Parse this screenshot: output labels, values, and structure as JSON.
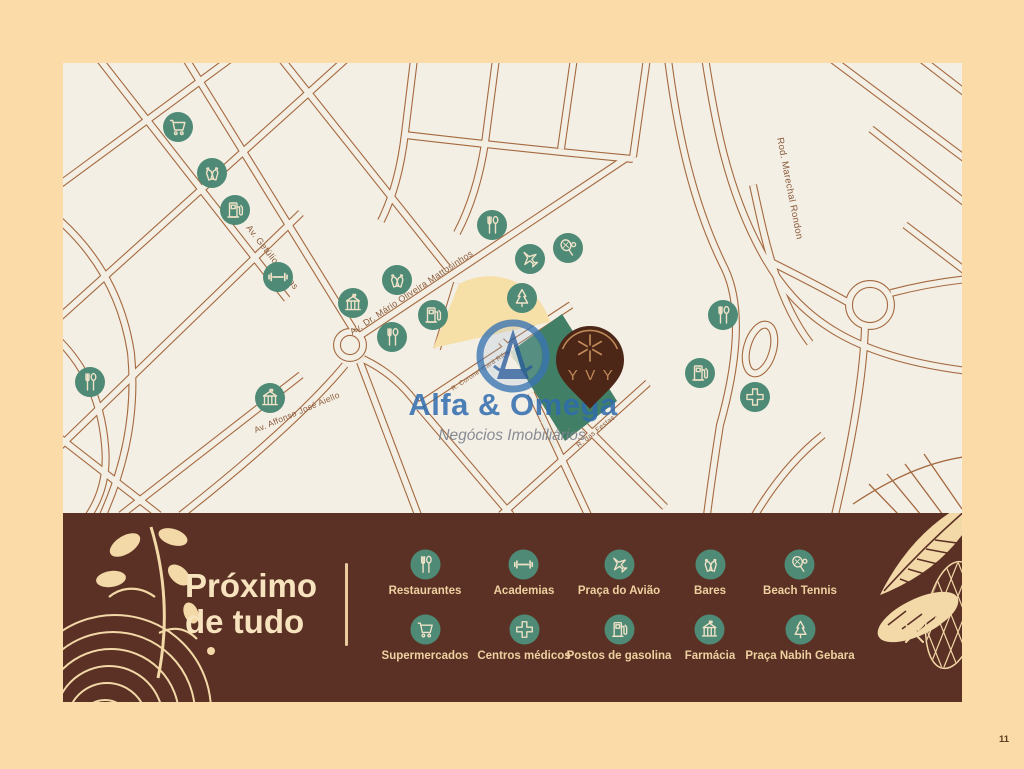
{
  "page": {
    "number": "11"
  },
  "watermark": {
    "title": "Alfa & Omega",
    "subtitle": "Negócios Imobiliários"
  },
  "pin": {
    "label": "YVY"
  },
  "map": {
    "street_labels": [
      {
        "text": "Av. Getúlio Vargas",
        "x": 207,
        "y": 196,
        "angle": 52,
        "size": 9
      },
      {
        "text": "Av. Dr. Mário Oliveira Mattosinhos",
        "x": 350,
        "y": 232,
        "angle": -33.5,
        "size": 9
      },
      {
        "text": "Av. Affonso José Aiello",
        "x": 235,
        "y": 352,
        "angle": -23,
        "size": 8.5
      },
      {
        "text": "Rod. Marechal Rondon",
        "x": 724,
        "y": 126,
        "angle": 79,
        "size": 9.5
      },
      {
        "text": "R. das Festas",
        "x": 534,
        "y": 370,
        "angle": -39,
        "size": 7
      },
      {
        "text": "R. Coronel Cará Ribas",
        "x": 420,
        "y": 308,
        "angle": -33.5,
        "size": 6.5
      },
      {
        "text": "R. Joaquim Lima",
        "x": 480,
        "y": 362,
        "angle": 65,
        "size": 6.5,
        "light": true
      }
    ],
    "pois": [
      {
        "type": "cart",
        "x": 115,
        "y": 64
      },
      {
        "type": "bar",
        "x": 149,
        "y": 110
      },
      {
        "type": "gas",
        "x": 172,
        "y": 147
      },
      {
        "type": "gym",
        "x": 215,
        "y": 214
      },
      {
        "type": "building",
        "x": 290,
        "y": 240
      },
      {
        "type": "bar",
        "x": 334,
        "y": 217
      },
      {
        "type": "restaurant",
        "x": 329,
        "y": 274
      },
      {
        "type": "gas",
        "x": 370,
        "y": 252
      },
      {
        "type": "restaurant",
        "x": 429,
        "y": 162
      },
      {
        "type": "plane",
        "x": 467,
        "y": 196
      },
      {
        "type": "tree",
        "x": 459,
        "y": 235
      },
      {
        "type": "restaurant",
        "x": 27,
        "y": 319
      },
      {
        "type": "building",
        "x": 207,
        "y": 335
      },
      {
        "type": "tennis",
        "x": 505,
        "y": 185
      },
      {
        "type": "restaurant",
        "x": 660,
        "y": 252
      },
      {
        "type": "gas",
        "x": 637,
        "y": 310
      },
      {
        "type": "cross",
        "x": 692,
        "y": 334
      }
    ]
  },
  "legend": {
    "heading_line1": "Próximo",
    "heading_line2": "de tudo",
    "rows": [
      [
        {
          "icon": "restaurant",
          "label": "Restaurantes"
        },
        {
          "icon": "gym",
          "label": "Academias"
        },
        {
          "icon": "plane",
          "label": "Praça do Avião"
        },
        {
          "icon": "bar",
          "label": "Bares"
        },
        {
          "icon": "tennis",
          "label": "Beach Tennis"
        }
      ],
      [
        {
          "icon": "cart",
          "label": "Supermercados"
        },
        {
          "icon": "cross",
          "label": "Centros médicos"
        },
        {
          "icon": "gas",
          "label": "Postos de gasolina"
        },
        {
          "icon": "building",
          "label": "Farmácia"
        },
        {
          "icon": "tree",
          "label": "Praça Nabih Gebara"
        }
      ]
    ]
  },
  "colors": {
    "background": "#FBDCA9",
    "map_background": "#F4EFE5",
    "road_line": "#A4693F",
    "poi_circle": "#4E8A75",
    "icon_glyph": "#EFE2C8",
    "band_background": "#5A3124",
    "band_heading": "#F7E3BE",
    "band_label": "#EFD0A0",
    "band_decoration": "#F3D8A8",
    "pin_fill": "#4C2718",
    "pin_accent": "#C08A58",
    "area_highlight": "#F7DFA8",
    "property_area": "#417F66",
    "watermark_blue": "#2F6CAE",
    "watermark_gray": "#7E848E",
    "street_label": "#8A5B3B",
    "page_number": "#5C3D20"
  }
}
